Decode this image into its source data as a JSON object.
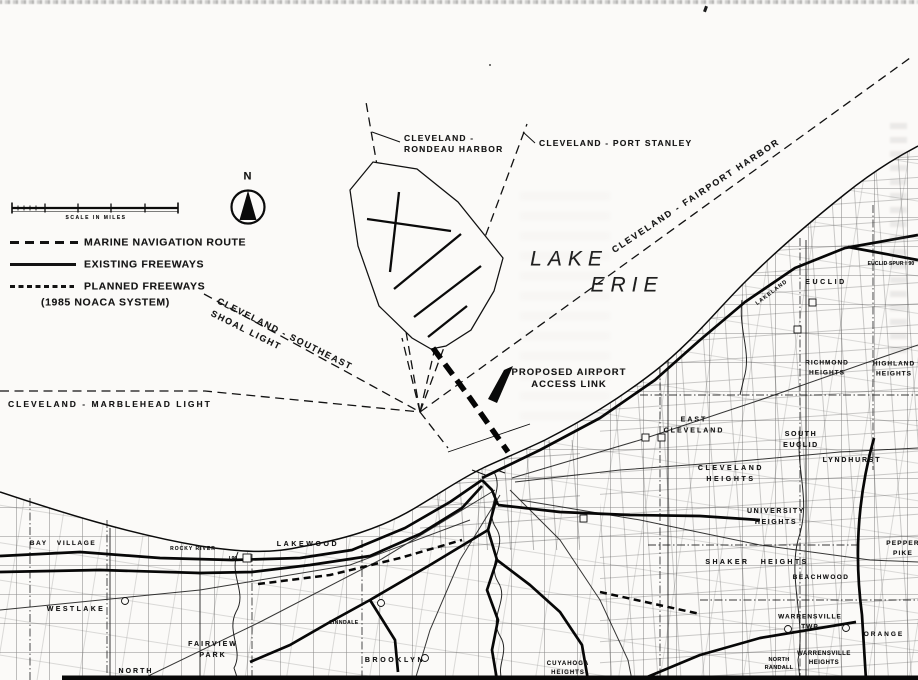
{
  "colors": {
    "ink": "#161616",
    "paper": "#fbfaf8"
  },
  "lake": {
    "word1": "LAKE",
    "word2": "ERIE"
  },
  "legend": {
    "north_label": "N",
    "scale_caption": "SCALE   IN   MILES",
    "items": [
      {
        "id": "marine",
        "label": "MARINE NAVIGATION ROUTE"
      },
      {
        "id": "existing",
        "label": "EXISTING FREEWAYS"
      },
      {
        "id": "planned",
        "label": "PLANNED FREEWAYS"
      }
    ],
    "planned_note": "(1985 NOACA SYSTEM)"
  },
  "routes": {
    "rondeau": "CLEVELAND -\nRONDEAU HARBOR",
    "port_stanley": "CLEVELAND - PORT STANLEY",
    "fairport": "CLEVELAND - FAIRPORT HARBOR",
    "southeast_shoal": "CLEVELAND - SOUTHEAST\nSHOAL LIGHT",
    "marblehead": "CLEVELAND - MARBLEHEAD LIGHT"
  },
  "annotations": {
    "access_link": "PROPOSED AIRPORT\nACCESS LINK",
    "euclid_spur": "EUCLID SPUR I 90",
    "lakeland_fwy": "LAKELAND",
    "i90_badge": "I 90"
  },
  "places": [
    {
      "name": "BAY VILLAGE"
    },
    {
      "name": "WESTLAKE"
    },
    {
      "name": "NORTH"
    },
    {
      "name": "FAIRVIEW\nPARK"
    },
    {
      "name": "LAKEWOOD"
    },
    {
      "name": "ROCKY RIVER"
    },
    {
      "name": "LINNDALE"
    },
    {
      "name": "BROOKLYN"
    },
    {
      "name": "CUYAHOGA\nHEIGHTS"
    },
    {
      "name": "EAST\nCLEVELAND"
    },
    {
      "name": "CLEVELAND\nHEIGHTS"
    },
    {
      "name": "SOUTH\nEUCLID"
    },
    {
      "name": "LYNDHURST"
    },
    {
      "name": "UNIVERSITY\nHEIGHTS"
    },
    {
      "name": "SHAKER HEIGHTS"
    },
    {
      "name": "BEACHWOOD"
    },
    {
      "name": "WARRENSVILLE\nTWP"
    },
    {
      "name": "WARRENSVILLE\nHEIGHTS"
    },
    {
      "name": "NORTH\nRANDALL"
    },
    {
      "name": "ORANGE"
    },
    {
      "name": "RICHMOND\nHEIGHTS"
    },
    {
      "name": "HIGHLAND\nHEIGHTS"
    },
    {
      "name": "EUCLID"
    },
    {
      "name": "PEPPER\nPIKE"
    }
  ]
}
